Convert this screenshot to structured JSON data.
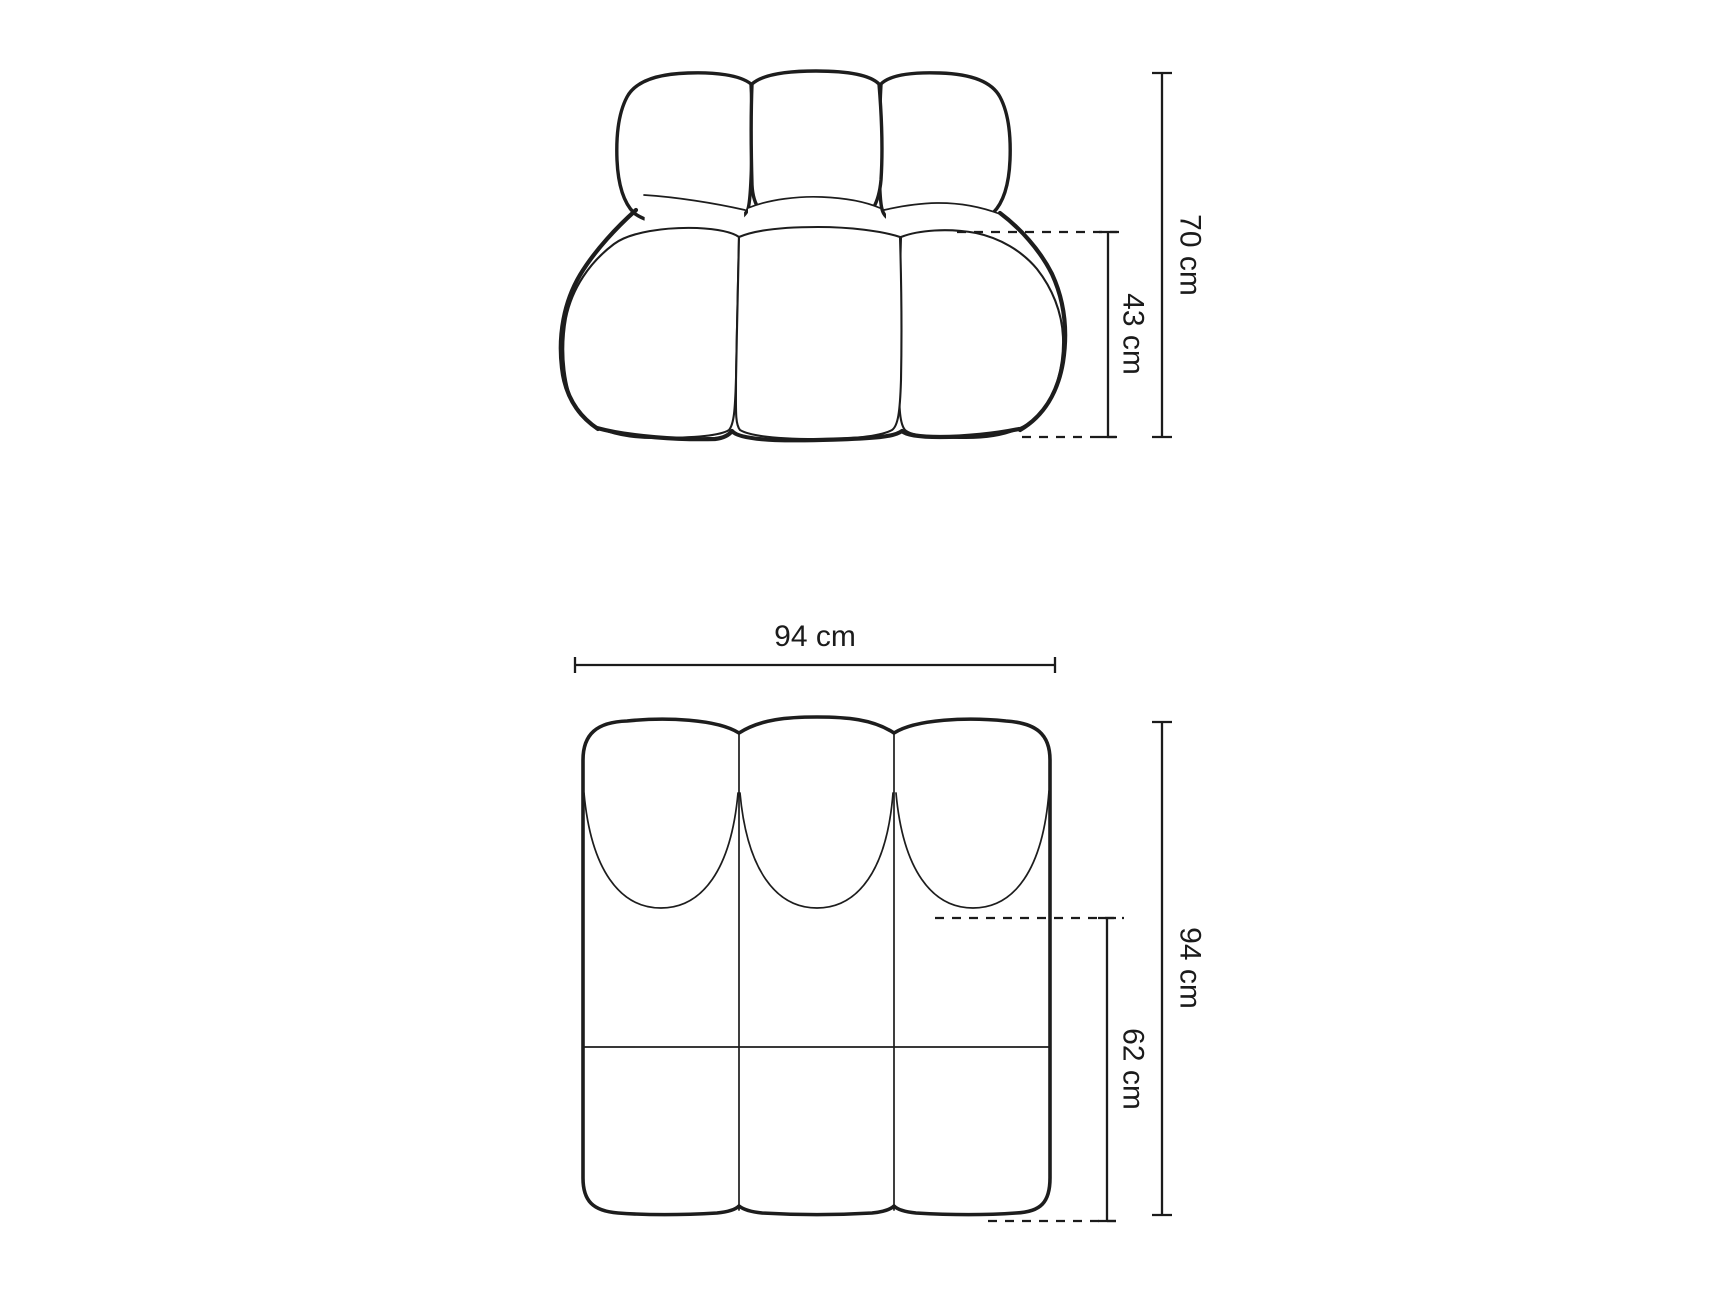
{
  "diagram": {
    "colors": {
      "background": "#ffffff",
      "line": "#1d1d1d",
      "dimension_line": "#1b1b1b",
      "label_text": "#1b1b1b"
    },
    "labels": {
      "front_total_height": "70 cm",
      "front_seat_height": "43 cm",
      "top_width": "94 cm",
      "top_depth": "94 cm",
      "top_seat_depth": "62 cm"
    }
  }
}
